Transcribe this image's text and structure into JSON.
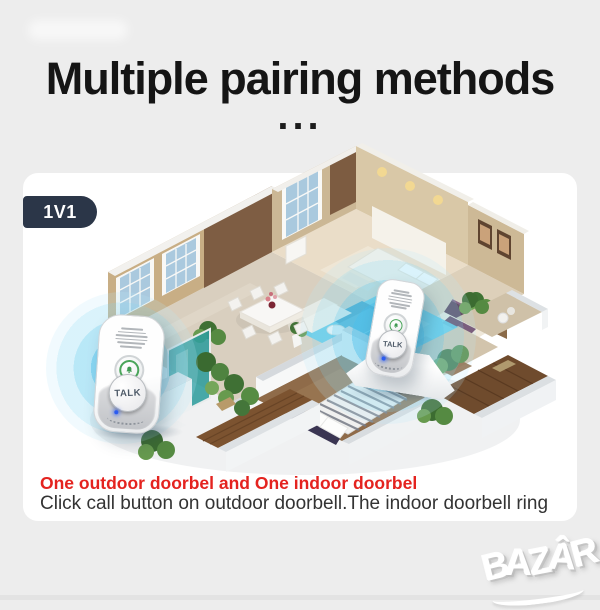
{
  "header": {
    "title": "Multiple pairing methods",
    "ellipsis": "..."
  },
  "card": {
    "badge_label": "1V1"
  },
  "devices": {
    "outdoor_doorbell": {
      "button_label": "TALK"
    },
    "indoor_doorbell": {
      "button_label": "TALK"
    }
  },
  "captions": {
    "highlight": "One outdoor doorbel and One indoor doorbel",
    "description": "Click call button on outdoor doorbell.The indoor doorbell ring"
  },
  "watermark": {
    "brand": "BAZÂR"
  },
  "colors": {
    "page_bg": "#ededed",
    "card_bg": "#ffffff",
    "badge_bg": "#2b3648",
    "highlight_red": "#e4231f",
    "signal_blue": "#5bc8ea",
    "title": "#151515"
  }
}
